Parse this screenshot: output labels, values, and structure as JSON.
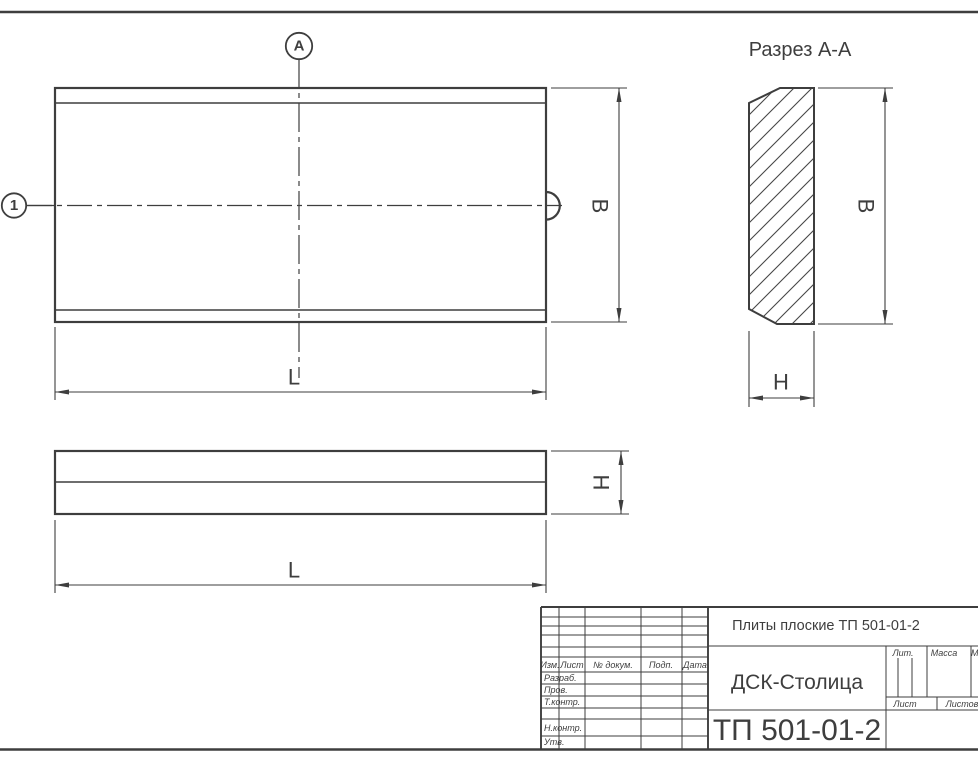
{
  "drawing": {
    "section_title": "Разрез А-А",
    "section_marker_letter": "А",
    "position_marker_number": "1"
  },
  "dimensions": {
    "plan_width": "B",
    "plan_length": "L",
    "section_width": "B",
    "section_height": "H",
    "side_height": "H",
    "side_length": "L"
  },
  "title_block": {
    "document_title": "Плиты плоские ТП 501-01-2",
    "organization": "ДСК-Столица",
    "document_number": "ТП 501-01-2",
    "revision_header": {
      "izm": "Изм.",
      "list": "Лист",
      "num_dokum": "№ докум.",
      "podp": "Подп.",
      "data": "Дата"
    },
    "roles": {
      "razrab": "Разраб.",
      "prov": "Пров.",
      "t_kontr": "Т.контр.",
      "n_kontr": "Н.контр.",
      "utv": "Утв."
    },
    "props": {
      "lit": "Лит.",
      "massa": "Масса",
      "masshtab": "Масштаб",
      "list": "Лист",
      "listov": "Листов"
    }
  },
  "colors": {
    "line": "#3e3e3e",
    "background": "#ffffff"
  }
}
